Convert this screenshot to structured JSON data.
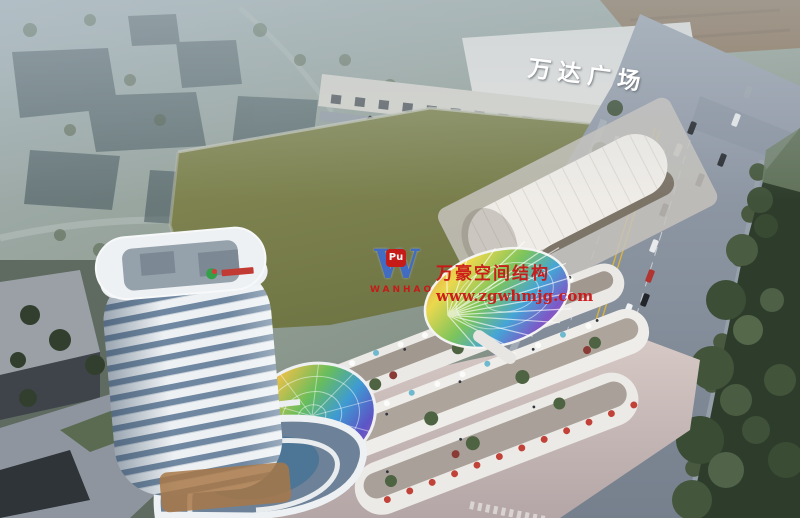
{
  "scene": {
    "description": "Aerial dusk architectural rendering of a mixed-use commercial complex with a white high-rise tower, curved retail terraces, two rainbow glass canopies, an empty green lot, and a tree-lined avenue beside Wanda Plaza",
    "colors": {
      "haze": "#aebdc6",
      "field_green": "#7d8251",
      "road_grey": "#8b95a3",
      "deep_green": "#2e3d2b",
      "tower_white": "#eef1f4",
      "glass_blue": "#6f87a0",
      "plaza_dusk": "#d3c6c3",
      "accent_red": "#c14238",
      "wm_red": "#cc1616",
      "wm_blue": "#3f6cc9",
      "sign_white": "#ffffff"
    }
  },
  "signs": {
    "wanda_plaza": "万达广场"
  },
  "watermark": {
    "logo_letter": "W",
    "logo_badge": "Pu",
    "logo_name": "WANHAO",
    "title": "万豪空间结构",
    "url": "www.zgwhmjg.com"
  }
}
